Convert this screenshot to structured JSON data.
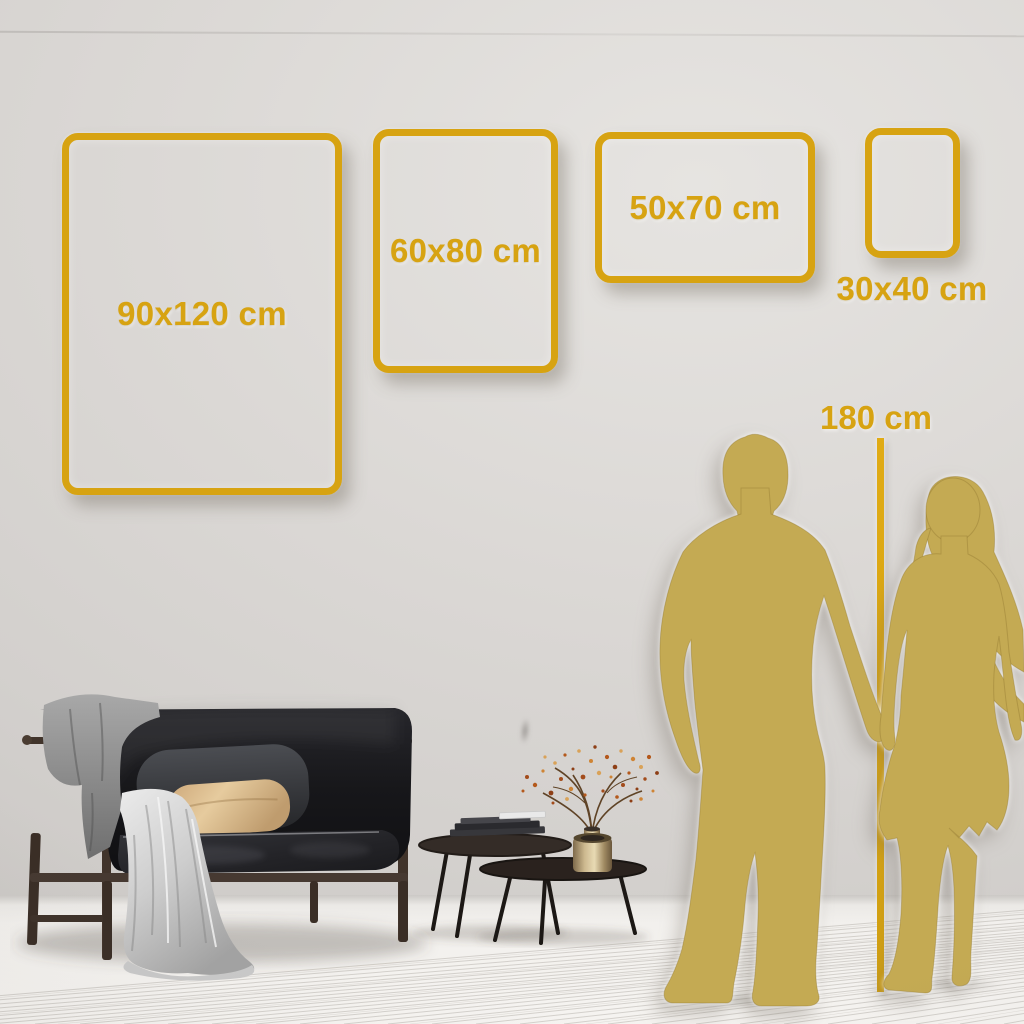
{
  "scene": {
    "title": "Poster size guide wall scene",
    "colors": {
      "gold_accent": "#d7a312",
      "silhouette_gold": "#c4aa53",
      "wall": "#d8d5d2",
      "floor": "#f2f0ed"
    }
  },
  "size_frames": [
    {
      "label": "90x120 cm",
      "width_cm": 90,
      "height_cm": 120,
      "orientation": "portrait",
      "label_position": "inside"
    },
    {
      "label": "60x80 cm",
      "width_cm": 60,
      "height_cm": 80,
      "orientation": "portrait",
      "label_position": "inside"
    },
    {
      "label": "50x70 cm",
      "width_cm": 50,
      "height_cm": 70,
      "orientation": "landscape",
      "label_position": "inside"
    },
    {
      "label": "30x40 cm",
      "width_cm": 30,
      "height_cm": 40,
      "orientation": "portrait",
      "label_position": "below"
    }
  ],
  "height_marker": {
    "label": "180 cm"
  }
}
